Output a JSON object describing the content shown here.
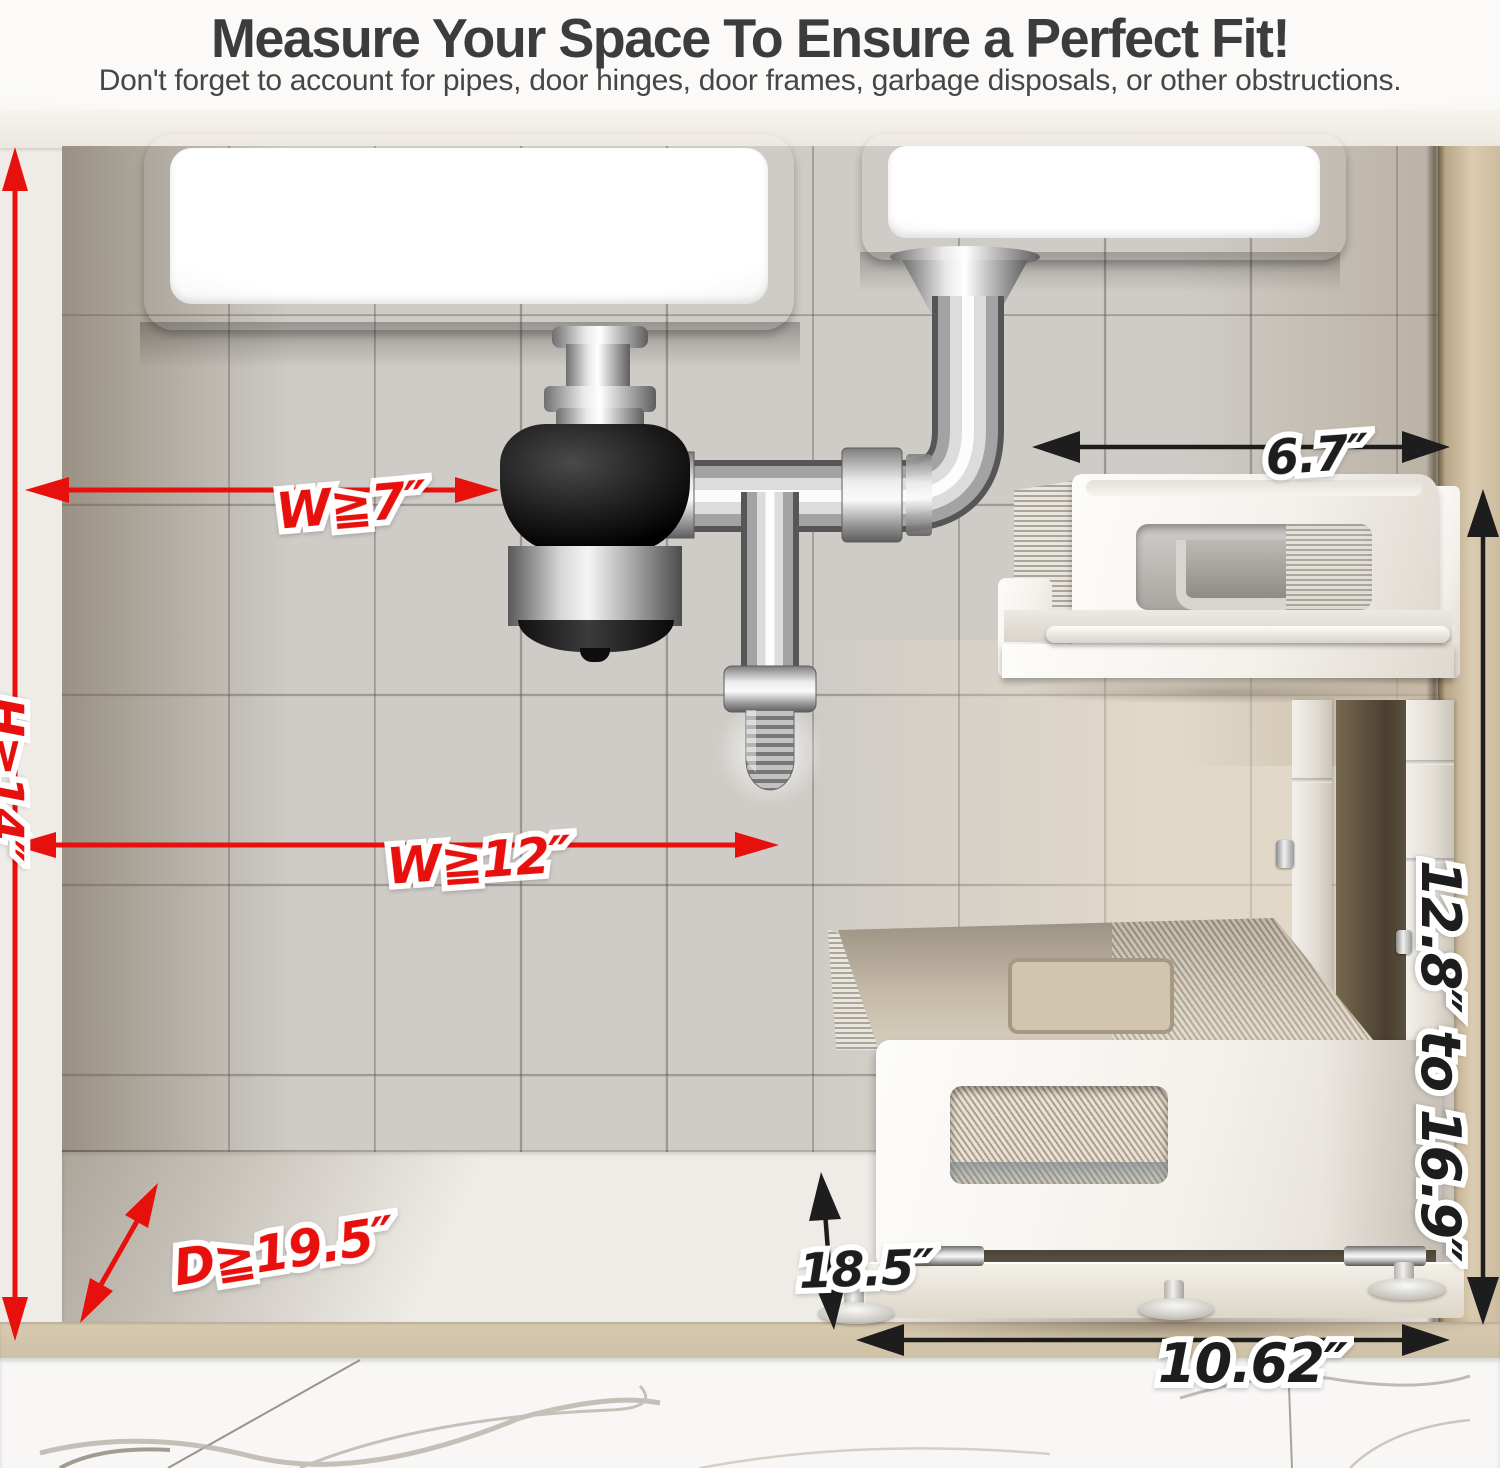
{
  "header": {
    "title": "Measure Your Space To Ensure a Perfect Fit!",
    "subtitle": "Don't forget to account for pipes, door hinges, door frames, garbage disposals, or other obstructions."
  },
  "cabinet_requirements": {
    "height_min": "H≧14″",
    "disposal_clearance_width_min": "W≧7″",
    "width_min": "W≧12″",
    "depth_min": "D≧19.5″"
  },
  "product_dimensions": {
    "top_tier_width": "6.7″",
    "adjustable_height_range": "12.8″ to 16.9″",
    "bottom_tier_depth": "18.5″",
    "bottom_tier_width": "10.62″"
  },
  "colors": {
    "measurement_red": "#e8100c",
    "measurement_black": "#1d1d1d",
    "title_text": "#3c3c3c"
  }
}
